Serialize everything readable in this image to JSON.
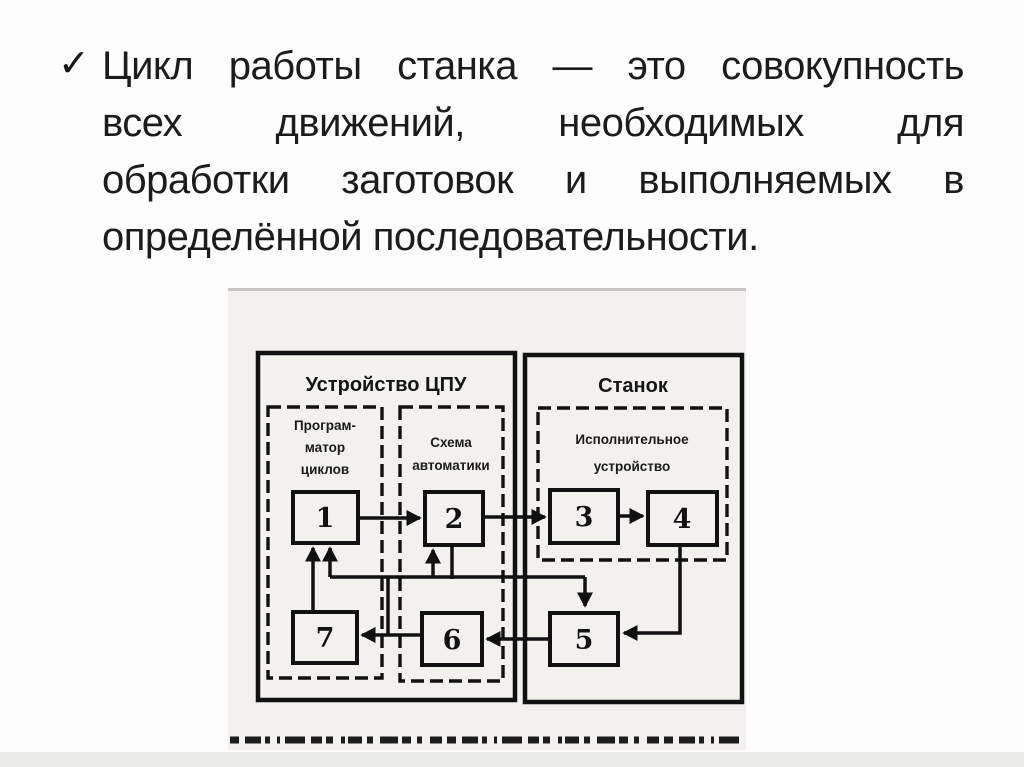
{
  "bullet": {
    "marker": "✓",
    "lines": [
      "Цикл работы станка — это совокупность",
      "всех движений, необходимых для",
      "обработки заготовок и выполняемых в",
      "определённой последовательности."
    ]
  },
  "diagram": {
    "titles": {
      "cpu": "Устройство ЦПУ",
      "machine": "Станок"
    },
    "groups": {
      "programmer": {
        "lines": [
          "Програм-",
          "матор",
          "циклов"
        ]
      },
      "automation": {
        "lines": [
          "Схема",
          "автоматики"
        ]
      },
      "actuator": {
        "lines": [
          "Исполнительное",
          "устройство"
        ]
      }
    },
    "blocks": [
      "1",
      "2",
      "3",
      "4",
      "5",
      "6",
      "7"
    ],
    "connections": [
      {
        "from": "1",
        "to": "2"
      },
      {
        "from": "2",
        "to": "3"
      },
      {
        "from": "3",
        "to": "4"
      },
      {
        "from": "4",
        "to": "5"
      },
      {
        "from": "5",
        "to": "6"
      },
      {
        "from": "6",
        "to": "7"
      },
      {
        "from": "7",
        "to": "1"
      },
      {
        "from": "feedback-bus",
        "to": "1"
      },
      {
        "from": "feedback-bus",
        "to": "2"
      },
      {
        "from": "2",
        "to": "feedback-bus"
      },
      {
        "from": "feedback-bus",
        "to": "5"
      },
      {
        "from": "6-7-line",
        "to": "feedback-bus"
      }
    ]
  },
  "colors": {
    "ink": "#111111",
    "scan_background": "#f2f1ee",
    "page_background": "#fdfdfd",
    "bottom_bar": "#e8e8e7"
  }
}
